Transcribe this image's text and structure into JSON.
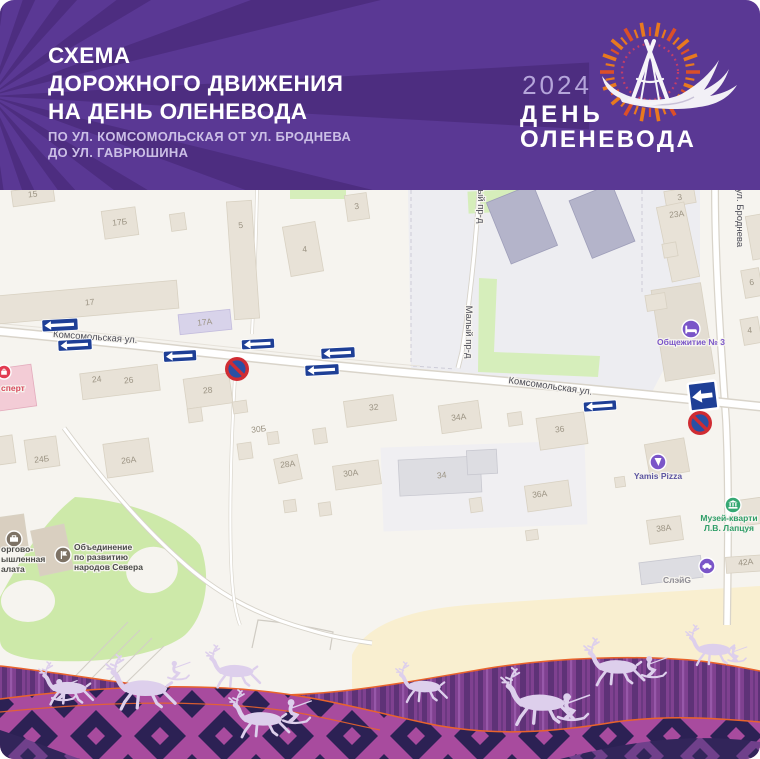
{
  "header": {
    "title_lines": [
      "СХЕМА",
      "ДОРОЖНОГО ДВИЖЕНИЯ",
      "НА ДЕНЬ ОЛЕНЕВОДА"
    ],
    "subtitle_lines": [
      "ПО УЛ. КОМСОМОЛЬСКАЯ ОТ УЛ. БРОДНЕВА",
      "ДО УЛ. ГАВРЮШИНА"
    ],
    "bg_color": "#5a3894",
    "ray_color": "#4d2d80"
  },
  "logo": {
    "year": "2024",
    "title_line1": "ДЕНЬ",
    "title_line2": "ОЛЕНЕВОДА",
    "year_color": "#b5a5da",
    "ray_orange": "#e8791f",
    "ray_red": "#dc4f28",
    "dotted_ring_color": "#c33e68"
  },
  "map": {
    "bg_color": "#f6f4ef",
    "street_labels": [
      {
        "text": "Комсомольская ул.",
        "x": 95,
        "y": 340,
        "rotate": 4
      },
      {
        "text": "Комсомольская ул.",
        "x": 550,
        "y": 389,
        "rotate": 8
      },
      {
        "text": "Малый пр-д",
        "x": 466,
        "y": 332,
        "rotate": 90
      },
      {
        "text": "Малый пр-д",
        "x": 478,
        "y": 197,
        "rotate": 90
      },
      {
        "text": "ул. Броднева",
        "x": 737,
        "y": 218,
        "rotate": 90
      }
    ],
    "building_labels": [
      {
        "t": "15",
        "x": 33,
        "y": 197
      },
      {
        "t": "17Б",
        "x": 120,
        "y": 225
      },
      {
        "t": "5",
        "x": 241,
        "y": 228
      },
      {
        "t": "17",
        "x": 90,
        "y": 305
      },
      {
        "t": "17А",
        "x": 205,
        "y": 325
      },
      {
        "t": "3",
        "x": 357,
        "y": 209
      },
      {
        "t": "4",
        "x": 305,
        "y": 252
      },
      {
        "t": "3",
        "x": 680,
        "y": 200
      },
      {
        "t": "23А",
        "x": 677,
        "y": 217
      },
      {
        "t": "6",
        "x": 752,
        "y": 285
      },
      {
        "t": "4",
        "x": 750,
        "y": 333
      },
      {
        "t": "24",
        "x": 97,
        "y": 382
      },
      {
        "t": "26",
        "x": 129,
        "y": 383
      },
      {
        "t": "28",
        "x": 208,
        "y": 393
      },
      {
        "t": "24Б",
        "x": 42,
        "y": 462
      },
      {
        "t": "26А",
        "x": 129,
        "y": 463
      },
      {
        "t": "30Б",
        "x": 259,
        "y": 432
      },
      {
        "t": "28А",
        "x": 288,
        "y": 467
      },
      {
        "t": "30А",
        "x": 351,
        "y": 476
      },
      {
        "t": "32",
        "x": 374,
        "y": 410
      },
      {
        "t": "34А",
        "x": 459,
        "y": 420
      },
      {
        "t": "36",
        "x": 560,
        "y": 432
      },
      {
        "t": "34",
        "x": 442,
        "y": 478
      },
      {
        "t": "36А",
        "x": 540,
        "y": 497
      },
      {
        "t": "38А",
        "x": 664,
        "y": 531
      },
      {
        "t": "42А",
        "x": 746,
        "y": 565
      }
    ],
    "pois": [
      {
        "name": "ekspert",
        "lines": [
          "сперт"
        ],
        "lx": 1,
        "ly": 391,
        "anchor": "start",
        "text_color": "#d8495c",
        "icon": {
          "x": 4,
          "y": 372,
          "r": 7,
          "color": "#e23c52",
          "glyph": "shop"
        }
      },
      {
        "name": "torgovo-palata",
        "lines": [
          "оргово-",
          "ышленная",
          "алата"
        ],
        "lx": 1,
        "ly": 552,
        "anchor": "start",
        "text_color": "#4a4a48",
        "icon": {
          "x": 14,
          "y": 539,
          "r": 8,
          "color": "#7d7265",
          "glyph": "briefcase"
        }
      },
      {
        "name": "obedinenie-narodov-severa",
        "lines": [
          "Объединение",
          "по развитию",
          "народов Севера"
        ],
        "lx": 74,
        "ly": 550,
        "anchor": "start",
        "text_color": "#4a4a48",
        "icon": {
          "x": 63,
          "y": 555,
          "r": 8,
          "color": "#7d7265",
          "glyph": "flag"
        }
      },
      {
        "name": "obshchezhitie-3",
        "lines": [
          "Общежитие № 3"
        ],
        "lx": 691,
        "ly": 345,
        "anchor": "middle",
        "text_color": "#7a55c8",
        "icon": {
          "x": 691,
          "y": 329,
          "r": 9,
          "color": "#7a55c8",
          "glyph": "bed"
        }
      },
      {
        "name": "yamis-pizza",
        "lines": [
          "Yamis Pizza"
        ],
        "lx": 658,
        "ly": 479,
        "anchor": "middle",
        "text_color": "#5b54a0",
        "icon": {
          "x": 658,
          "y": 462,
          "r": 8,
          "color": "#7a55c8",
          "glyph": "food"
        }
      },
      {
        "name": "muzey-laptsuya",
        "lines": [
          "Музей-кварти",
          "Л.В. Лапцуя"
        ],
        "lx": 729,
        "ly": 521,
        "anchor": "middle",
        "text_color": "#2f9e68",
        "icon": {
          "x": 733,
          "y": 505,
          "r": 8,
          "color": "#35a873",
          "glyph": "museum"
        }
      },
      {
        "name": "sleyg",
        "lines": [
          "СлэйG"
        ],
        "lx": 677,
        "ly": 583,
        "anchor": "middle",
        "text_color": "#8f8d95",
        "icon": {
          "x": 707,
          "y": 566,
          "r": 8,
          "color": "#7a55c8",
          "glyph": "car"
        }
      }
    ]
  },
  "traffic": {
    "arrow_color": "#1e3f96",
    "sign_red": "#d02c33",
    "sign_inner_blue": "#2a50a5",
    "one_way_arrows": [
      {
        "x": 60,
        "y": 325,
        "w": 36,
        "h": 12,
        "rot": -3
      },
      {
        "x": 75,
        "y": 345,
        "w": 34,
        "h": 11,
        "rot": -3
      },
      {
        "x": 180,
        "y": 356,
        "w": 33,
        "h": 11,
        "rot": -3
      },
      {
        "x": 258,
        "y": 344,
        "w": 33,
        "h": 10,
        "rot": -3
      },
      {
        "x": 338,
        "y": 353,
        "w": 34,
        "h": 11,
        "rot": -3
      },
      {
        "x": 322,
        "y": 370,
        "w": 34,
        "h": 11,
        "rot": -3
      },
      {
        "x": 600,
        "y": 406,
        "w": 33,
        "h": 10,
        "rot": -4
      }
    ],
    "square_sign": {
      "x": 703,
      "y": 396,
      "size": 28,
      "rot": -7
    },
    "no_parking_signs": [
      {
        "x": 237,
        "y": 369,
        "r": 12
      },
      {
        "x": 700,
        "y": 423,
        "r": 12
      }
    ]
  },
  "decor": {
    "wave_birch": "#7f4190",
    "wave_birch_dark": "#5e3277",
    "wave_magenta": "#a84b9e",
    "ornament_navy": "#2c2154",
    "accent_orange": "#e9632c",
    "deer_color": "#ddcfec"
  }
}
